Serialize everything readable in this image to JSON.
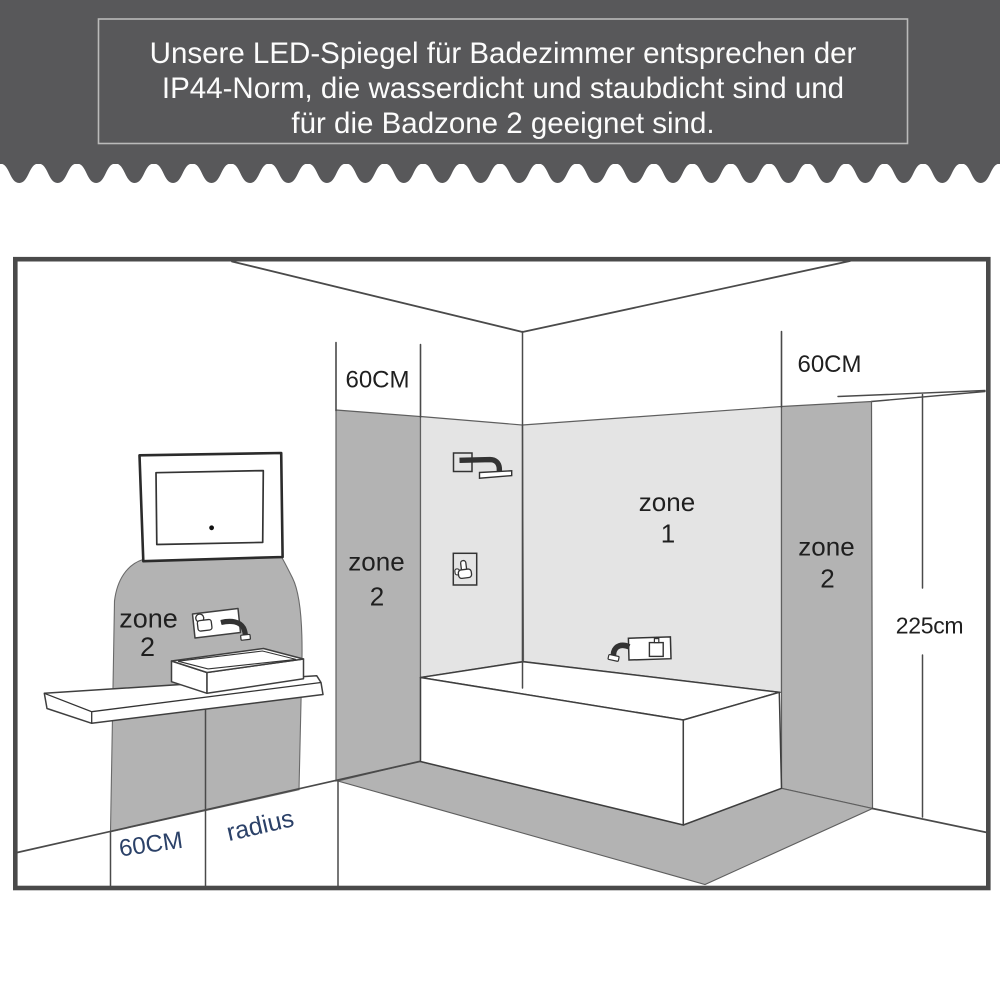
{
  "header": {
    "background_color": "#58585a",
    "border_color": "#bababa",
    "text_color": "#fcfcfc",
    "lines": [
      "Unsere LED-Spiegel für Badezimmer entsprechen der",
      "IP44-Norm, die wasserdicht und staubdicht sind und",
      "für die Badzone 2 geeignet sind."
    ]
  },
  "diagram": {
    "colors": {
      "zone_dark": "#b3b3b3",
      "zone_light": "#e4e4e4",
      "outline": "#4a4a4a",
      "label": "#1f1f1f",
      "label_accent": "#2b4168",
      "frame": "#4a4a4a"
    },
    "labels": {
      "zone_word": "zone",
      "zone1_number": "1",
      "zone2_number": "2",
      "width_top_left": "60CM",
      "width_top_right": "60CM",
      "width_floor": "60CM",
      "radius": "radius",
      "wall_height": "225cm"
    }
  }
}
